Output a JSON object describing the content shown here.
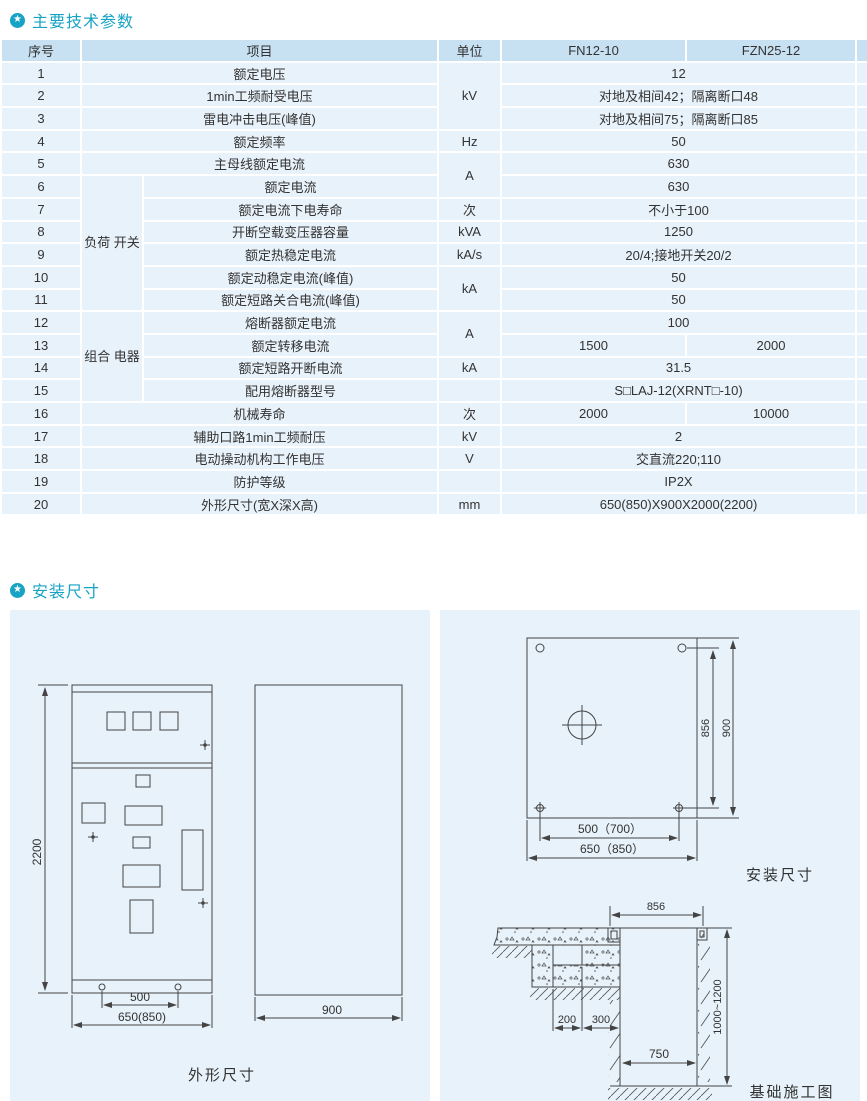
{
  "colors": {
    "accent": "#17a3c4",
    "table_header_bg": "#c7e0f2",
    "table_row_bg": "#e8f2fa",
    "panel_bg": "#e7f2fa",
    "line": "#444444"
  },
  "section1": {
    "title": "主要技术参数"
  },
  "section2": {
    "title": "安装尺寸"
  },
  "table": {
    "headers": {
      "no": "序号",
      "item": "项目",
      "unit": "单位",
      "col1": "FN12-10",
      "col2": "FZN25-12"
    },
    "rows": [
      {
        "no": "1",
        "item": "额定电压",
        "unit": "kV",
        "value": "12"
      },
      {
        "no": "2",
        "item": "1min工频耐受电压",
        "value": "对地及相间42；隔离断口48"
      },
      {
        "no": "3",
        "item": "雷电冲击电压(峰值)",
        "value": "对地及相间75；隔离断口85"
      },
      {
        "no": "4",
        "item": "额定频率",
        "unit": "Hz",
        "value": "50"
      },
      {
        "no": "5",
        "item": "主母线额定电流",
        "unit": "A",
        "value": "630"
      },
      {
        "no": "6",
        "item": "额定电流",
        "group": "负荷\n开关",
        "value": "630"
      },
      {
        "no": "7",
        "item": "额定电流下电寿命",
        "unit": "次",
        "value": "不小于100"
      },
      {
        "no": "8",
        "item": "开断空载变压器容量",
        "unit": "kVA",
        "value": "1250"
      },
      {
        "no": "9",
        "item": "额定热稳定电流",
        "unit": "kA/s",
        "value": "20/4;接地开关20/2"
      },
      {
        "no": "10",
        "item": "额定动稳定电流(峰值)",
        "unit": "kA",
        "value": "50"
      },
      {
        "no": "11",
        "item": "额定短路关合电流(峰值)",
        "value": "50"
      },
      {
        "no": "12",
        "item": "熔断器额定电流",
        "group": "组合\n电器",
        "unit": "A",
        "value": "100"
      },
      {
        "no": "13",
        "item": "额定转移电流",
        "v1": "1500",
        "v2": "2000"
      },
      {
        "no": "14",
        "item": "额定短路开断电流",
        "unit": "kA",
        "value": "31.5"
      },
      {
        "no": "15",
        "item": "配用熔断器型号",
        "unit": "",
        "value": "S□LAJ-12(XRNT□-10)"
      },
      {
        "no": "16",
        "item": "机械寿命",
        "unit": "次",
        "v1": "2000",
        "v2": "10000"
      },
      {
        "no": "17",
        "item": "辅助口路1min工频耐压",
        "unit": "kV",
        "value": "2"
      },
      {
        "no": "18",
        "item": "电动操动机构工作电压",
        "unit": "V",
        "value": "交直流220;110"
      },
      {
        "no": "19",
        "item": "防护等级",
        "unit": "",
        "value": "IP2X"
      },
      {
        "no": "20",
        "item": "外形尺寸(宽X深X高)",
        "unit": "mm",
        "value": "650(850)X900X2000(2200)"
      }
    ]
  },
  "drawings": {
    "outline": {
      "caption": "外形尺寸",
      "height": "2200",
      "base_inner": "500",
      "base_outer": "650(850)",
      "depth": "900"
    },
    "install": {
      "caption": "安装尺寸",
      "inner_h": "856",
      "outer_h": "900",
      "inner_w": "500（700）",
      "outer_w": "650（850）"
    },
    "foundation": {
      "caption": "基础施工图",
      "top": "856",
      "left": "200",
      "right": "300",
      "bottom": "750",
      "depth": "1000~1200"
    }
  }
}
